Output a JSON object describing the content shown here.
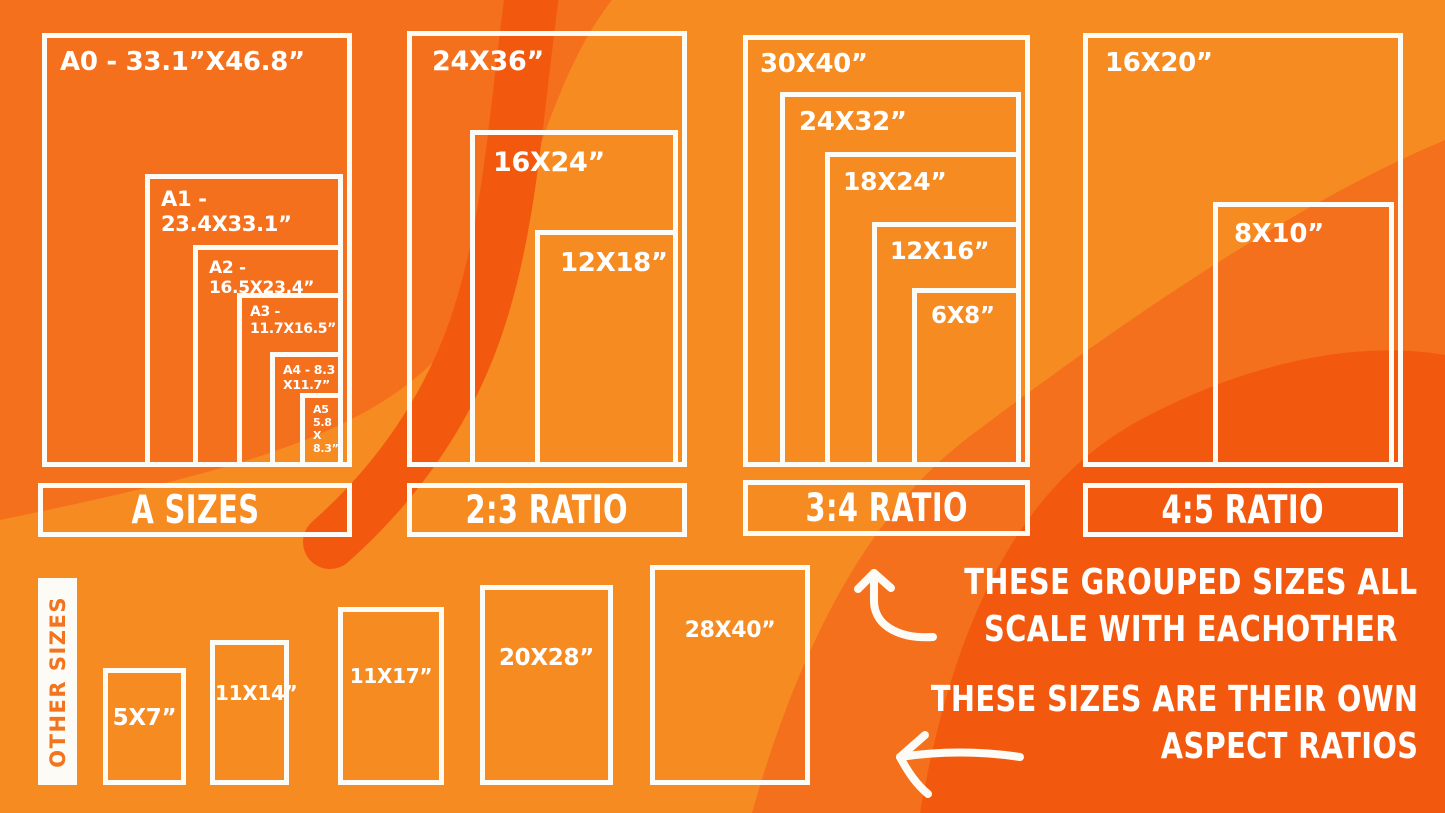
{
  "colors": {
    "base_orange": "#F4701D",
    "light_orange": "#F68B22",
    "deep_orange": "#F2590F",
    "line_white": "#FCFBF6",
    "other_sizes_text": "#F4731D"
  },
  "groups": [
    {
      "label": "A SIZES",
      "sizes": [
        {
          "label": "A0 - 33.1”X46.8”"
        },
        {
          "label": "A1 - 23.4X33.1”"
        },
        {
          "label": "A2 - 16.5X23.4”"
        },
        {
          "label": "A3 - 11.7X16.5”"
        },
        {
          "label": "A4 - 8.3\nX11.7”"
        },
        {
          "label": "A5\n5.8\nX\n8.3”"
        }
      ]
    },
    {
      "label": "2:3 RATIO",
      "sizes": [
        {
          "label": "24X36”"
        },
        {
          "label": "16X24”"
        },
        {
          "label": "12X18”"
        }
      ]
    },
    {
      "label": "3:4 RATIO",
      "sizes": [
        {
          "label": "30X40”"
        },
        {
          "label": "24X32”"
        },
        {
          "label": "18X24”"
        },
        {
          "label": "12X16”"
        },
        {
          "label": "6X8”"
        }
      ]
    },
    {
      "label": "4:5 RATIO",
      "sizes": [
        {
          "label": "16X20”"
        },
        {
          "label": "8X10”"
        }
      ]
    }
  ],
  "other": {
    "label": "OTHER SIZES",
    "items": [
      {
        "label": "5X7”"
      },
      {
        "label": "11X14”"
      },
      {
        "label": "11X17”"
      },
      {
        "label": "20X28”"
      },
      {
        "label": "28X40”"
      }
    ]
  },
  "annotations": {
    "grouped_line1": "THESE GROUPED SIZES ALL",
    "grouped_line2": "SCALE WITH EACHOTHER",
    "own_line1": "THESE SIZES ARE THEIR OWN",
    "own_line2": "ASPECT RATIOS"
  }
}
